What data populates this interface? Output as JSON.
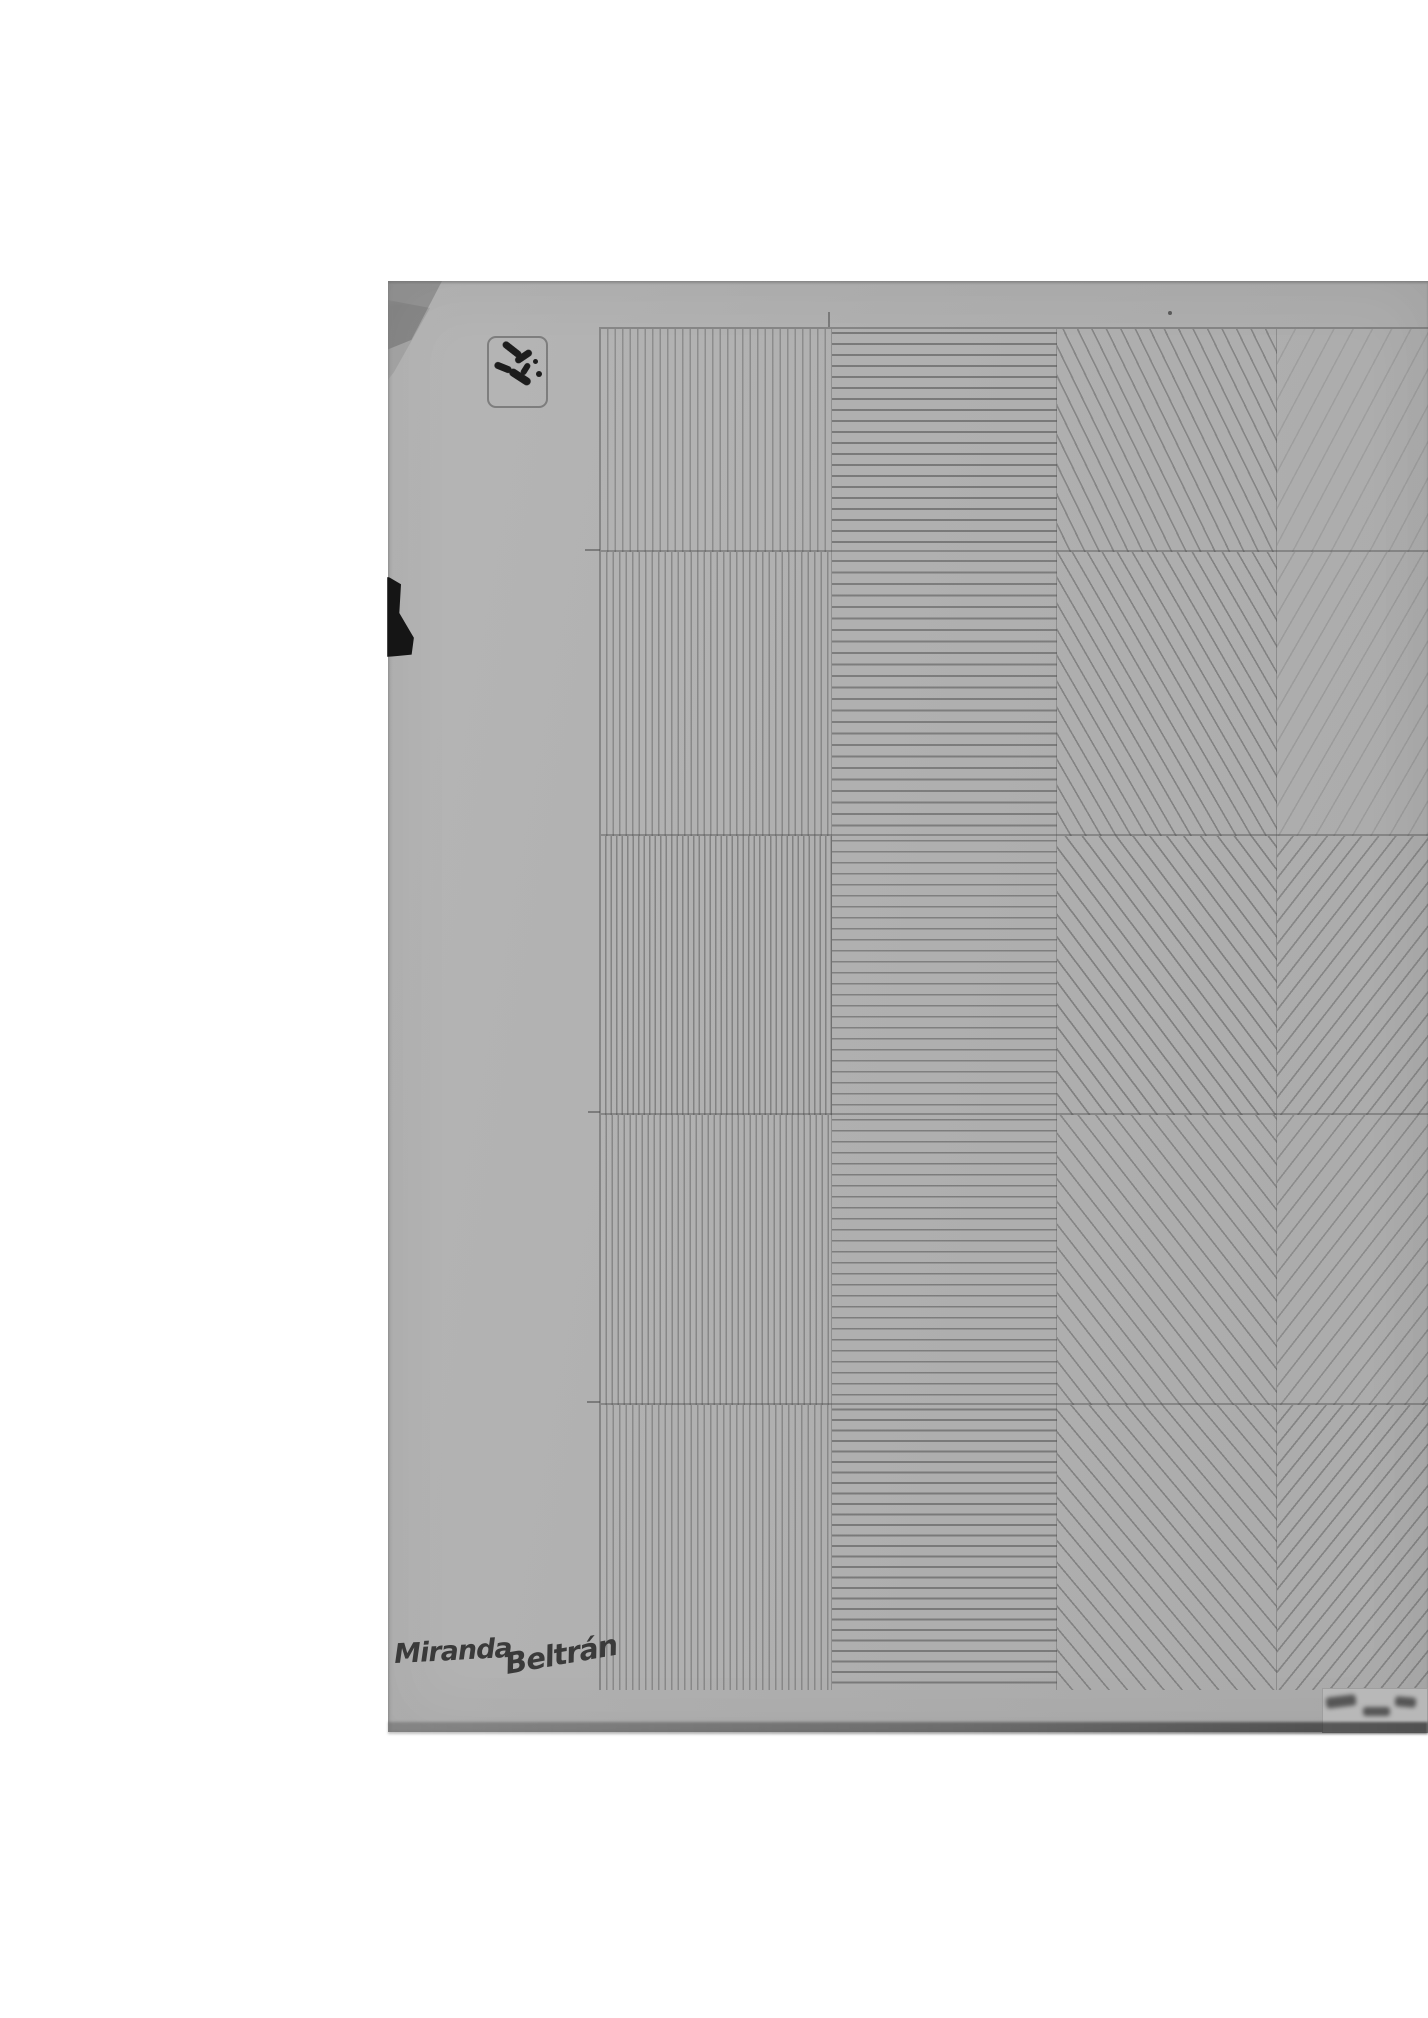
{
  "artwork": {
    "title": "Pencil hatching exercise grid on gray paper",
    "signature": "Miranda Beltrán",
    "signature_parts": [
      "Miranda",
      "Beltrán"
    ],
    "paper_color": "#b0b0b0",
    "background_color": "#ffffff",
    "pencil_color": "#373737",
    "ink_color": "#1d1d1d",
    "grid": {
      "rows": 5,
      "columns": 4,
      "col_widths": [
        231,
        225,
        220,
        220
      ],
      "row_heights": [
        223,
        284,
        279,
        290,
        287
      ],
      "column_patterns": [
        "vertical-lines",
        "horizontal-lines",
        "diagonal-down-lines",
        "diagonal-up-lines"
      ],
      "cells": [
        {
          "row": 1,
          "col": 1,
          "pattern": "vertical-lines",
          "angle": 90,
          "spacing": 7.5,
          "alpha": 0.3,
          "line_width": 1.4
        },
        {
          "row": 2,
          "col": 1,
          "pattern": "vertical-lines",
          "angle": 90,
          "spacing": 6.5,
          "alpha": 0.33,
          "line_width": 1.4
        },
        {
          "row": 3,
          "col": 1,
          "pattern": "vertical-lines",
          "angle": 90,
          "spacing": 5.5,
          "alpha": 0.38,
          "line_width": 1.5
        },
        {
          "row": 4,
          "col": 1,
          "pattern": "vertical-lines",
          "angle": 90,
          "spacing": 6.0,
          "alpha": 0.34,
          "line_width": 1.4
        },
        {
          "row": 5,
          "col": 1,
          "pattern": "vertical-lines",
          "angle": 90,
          "spacing": 6.5,
          "alpha": 0.32,
          "line_width": 1.4
        },
        {
          "row": 1,
          "col": 2,
          "pattern": "horizontal-lines",
          "angle": 0,
          "spacing": 11.0,
          "alpha": 0.45,
          "line_width": 1.8
        },
        {
          "row": 2,
          "col": 2,
          "pattern": "horizontal-lines",
          "angle": 0,
          "spacing": 11.5,
          "alpha": 0.42,
          "line_width": 1.8
        },
        {
          "row": 3,
          "col": 2,
          "pattern": "horizontal-lines",
          "angle": 0,
          "spacing": 11.0,
          "alpha": 0.4,
          "line_width": 1.7
        },
        {
          "row": 4,
          "col": 2,
          "pattern": "horizontal-lines",
          "angle": 0,
          "spacing": 11.0,
          "alpha": 0.42,
          "line_width": 1.7
        },
        {
          "row": 5,
          "col": 2,
          "pattern": "horizontal-lines",
          "angle": 0,
          "spacing": 10.5,
          "alpha": 0.44,
          "line_width": 1.8
        },
        {
          "row": 1,
          "col": 3,
          "pattern": "diagonal-down-lines",
          "angle": 64,
          "spacing": 13.0,
          "alpha": 0.34,
          "line_width": 1.6
        },
        {
          "row": 2,
          "col": 3,
          "pattern": "diagonal-down-lines",
          "angle": 60,
          "spacing": 13.0,
          "alpha": 0.36,
          "line_width": 1.6
        },
        {
          "row": 3,
          "col": 3,
          "pattern": "diagonal-down-lines",
          "angle": 53,
          "spacing": 13.5,
          "alpha": 0.38,
          "line_width": 1.7
        },
        {
          "row": 4,
          "col": 3,
          "pattern": "diagonal-down-lines",
          "angle": 52,
          "spacing": 14.0,
          "alpha": 0.34,
          "line_width": 1.6
        },
        {
          "row": 5,
          "col": 3,
          "pattern": "diagonal-down-lines",
          "angle": 50,
          "spacing": 14.0,
          "alpha": 0.36,
          "line_width": 1.6
        },
        {
          "row": 1,
          "col": 4,
          "pattern": "diagonal-up-lines",
          "angle": 118,
          "spacing": 17.0,
          "alpha": 0.13,
          "line_width": 1.5
        },
        {
          "row": 2,
          "col": 4,
          "pattern": "diagonal-up-lines",
          "angle": 120,
          "spacing": 16.0,
          "alpha": 0.15,
          "line_width": 1.5
        },
        {
          "row": 3,
          "col": 4,
          "pattern": "diagonal-up-lines",
          "angle": 128,
          "spacing": 13.5,
          "alpha": 0.32,
          "line_width": 1.7
        },
        {
          "row": 4,
          "col": 4,
          "pattern": "diagonal-up-lines",
          "angle": 128,
          "spacing": 14.0,
          "alpha": 0.28,
          "line_width": 1.6
        },
        {
          "row": 5,
          "col": 4,
          "pattern": "diagonal-up-lines",
          "angle": 129,
          "spacing": 13.0,
          "alpha": 0.34,
          "line_width": 1.7
        }
      ]
    }
  }
}
